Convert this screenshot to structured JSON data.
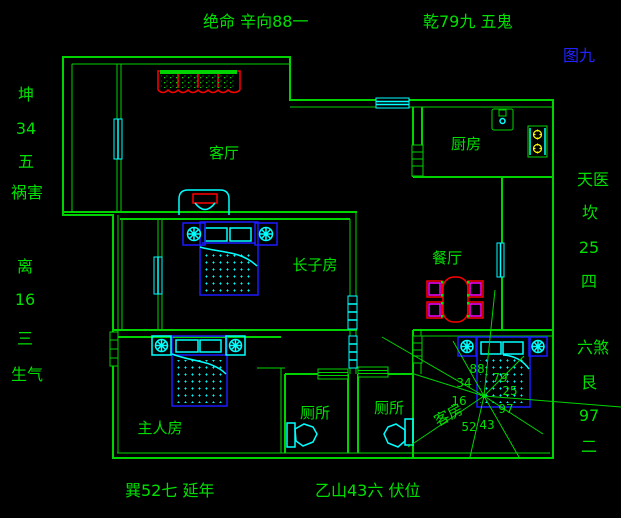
{
  "figure_label": "图九",
  "compass": {
    "top_left": "绝命 辛向88一",
    "top_right": "乾79九 五鬼",
    "left": [
      "坤",
      "34",
      "五",
      "祸害",
      "离",
      "16",
      "三",
      "生气"
    ],
    "right": [
      "天医",
      "坎",
      "25",
      "四",
      "六煞",
      "艮",
      "97",
      "二"
    ],
    "bottom_left": "巽52七  延年",
    "bottom_right": "乙山43六  伏位"
  },
  "rooms": {
    "living": "客厅",
    "kitchen": "厨房",
    "eldest_son": "长子房",
    "dining": "餐厅",
    "master": "主人房",
    "toilet1": "厕所",
    "toilet2": "厕所",
    "guest": "客房"
  },
  "guest_room_chart": {
    "n88": "88",
    "n79": "79",
    "n34": "34",
    "n25": "25",
    "n16": "16",
    "n97": "97",
    "n52": "52",
    "n43": "43"
  },
  "colors": {
    "wall_green": "#00d400",
    "text_green": "#00e000",
    "window_cyan": "#00ffff",
    "bed_blue": "#1a1aff",
    "furniture_red": "#ff0000",
    "chair_magenta": "#ff00ff",
    "stove_yellow": "#ffff00",
    "figure_blue": "#2222ff"
  }
}
